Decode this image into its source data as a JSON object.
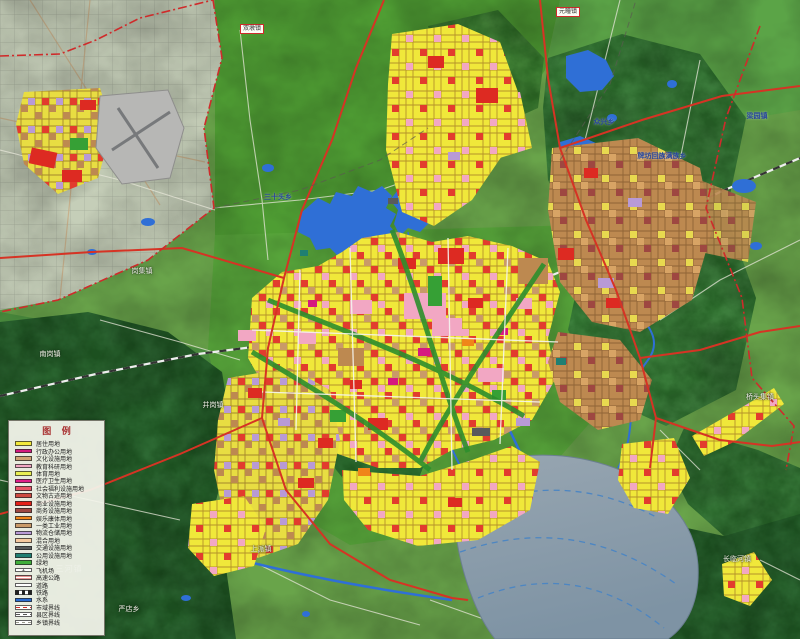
{
  "legend": {
    "title": "图 例",
    "items": [
      {
        "label": "居住用地",
        "kind": "fill",
        "color": "#f2e93c"
      },
      {
        "label": "行政办公用地",
        "kind": "fill",
        "color": "#d41a7f"
      },
      {
        "label": "文化设施用地",
        "kind": "fill",
        "color": "#cfa273"
      },
      {
        "label": "教育科研用地",
        "kind": "fill",
        "color": "#f2a7c3"
      },
      {
        "label": "体育用地",
        "kind": "fill",
        "color": "#e9ef52"
      },
      {
        "label": "医疗卫生用地",
        "kind": "fill",
        "color": "#e01f8a"
      },
      {
        "label": "社会福利设施用地",
        "kind": "fill",
        "color": "#e85568"
      },
      {
        "label": "文物古迹用地",
        "kind": "fill",
        "color": "#cc4a41"
      },
      {
        "label": "商业设施用地",
        "kind": "fill",
        "color": "#e32119"
      },
      {
        "label": "商务设施用地",
        "kind": "fill",
        "color": "#9e4741"
      },
      {
        "label": "娱乐康体用地",
        "kind": "fill",
        "color": "#f08519"
      },
      {
        "label": "一类工业用地",
        "kind": "fill",
        "color": "#c99a68"
      },
      {
        "label": "物流仓储用地",
        "kind": "fill",
        "color": "#b89ad6"
      },
      {
        "label": "混合用地",
        "kind": "fill",
        "color": "#f6c99f"
      },
      {
        "label": "交通设施用地",
        "kind": "fill",
        "color": "#595b5c"
      },
      {
        "label": "公用设施用地",
        "kind": "fill",
        "color": "#1f7f72"
      },
      {
        "label": "绿地",
        "kind": "fill",
        "color": "#3fae3a"
      },
      {
        "label": "飞机场",
        "kind": "airport",
        "color": "#ffffff",
        "glyph": "✈"
      },
      {
        "label": "高速公路",
        "kind": "line-red-double",
        "color": "#d63324"
      },
      {
        "label": "道路",
        "kind": "line-white",
        "color": "#ffffff"
      },
      {
        "label": "铁路",
        "kind": "line-rail",
        "color": "#222222"
      },
      {
        "label": "水系",
        "kind": "fill",
        "color": "#2a6bd2"
      },
      {
        "label": "市域界线",
        "kind": "line-red-dashdot",
        "color": "#cf2b2b"
      },
      {
        "label": "县区界线",
        "kind": "line-dash-gray",
        "color": "#555555"
      },
      {
        "label": "乡镇界线",
        "kind": "line-dash-light",
        "color": "#999999"
      }
    ]
  },
  "map_labels": [
    {
      "text": "双墩镇",
      "style": "box",
      "x": 252,
      "y": 29
    },
    {
      "text": "元疃镇",
      "style": "box",
      "x": 568,
      "y": 12
    },
    {
      "text": "梁园镇",
      "style": "blue",
      "x": 757,
      "y": 116
    },
    {
      "text": "众兴乡",
      "style": "blue",
      "x": 604,
      "y": 122
    },
    {
      "text": "牌坊回族满族乡",
      "style": "blue",
      "x": 662,
      "y": 156
    },
    {
      "text": "三十头乡",
      "style": "blue",
      "x": 278,
      "y": 197
    },
    {
      "text": "岗集镇",
      "style": "faint",
      "x": 142,
      "y": 271
    },
    {
      "text": "南岗镇",
      "style": "faint",
      "x": 50,
      "y": 354
    },
    {
      "text": "井岗镇",
      "style": "faint",
      "x": 213,
      "y": 405
    },
    {
      "text": "桥头集镇",
      "style": "faint",
      "x": 760,
      "y": 397
    },
    {
      "text": "上派镇",
      "style": "faint",
      "x": 261,
      "y": 549
    },
    {
      "text": "长临河镇",
      "style": "faint",
      "x": 737,
      "y": 559
    },
    {
      "text": "严店乡",
      "style": "faint",
      "x": 129,
      "y": 609
    },
    {
      "text": "三河镇",
      "style": "water",
      "x": 69,
      "y": 569
    }
  ],
  "colors": {
    "terrain_bright": "#4f9e33",
    "terrain_dark": "#2d6a33",
    "outside_boundary": "#c5ceb8",
    "lake": "#8da0ae",
    "water": "#2f6fd6",
    "expressway": "#d63324",
    "city_boundary": "#cf2b2b",
    "residential": "#f2e93c",
    "airport_gray": "#b7b7b5"
  }
}
